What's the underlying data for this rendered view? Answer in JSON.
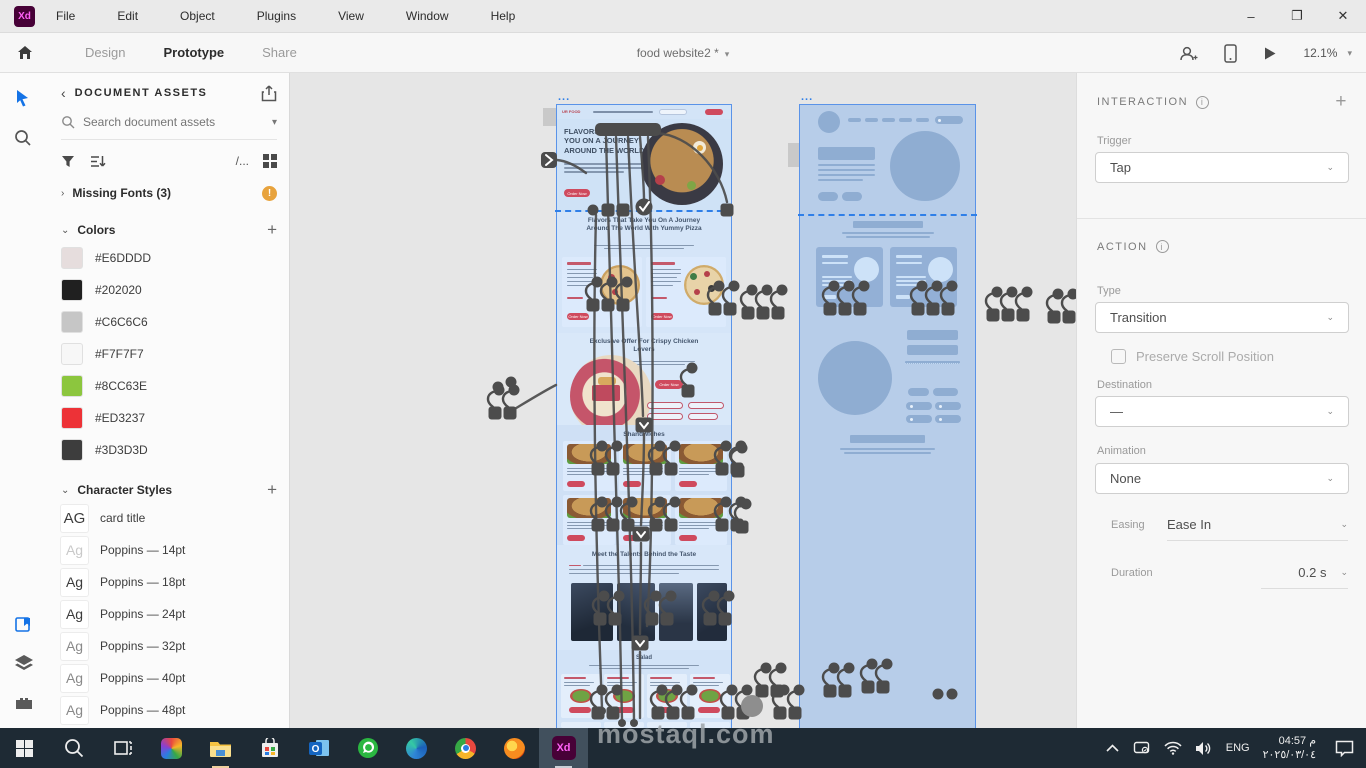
{
  "window": {
    "logo": "Xd",
    "menus": [
      "File",
      "Edit",
      "Object",
      "Plugins",
      "View",
      "Window",
      "Help"
    ],
    "controls": {
      "minimize": "–",
      "restore": "❐",
      "close": "✕"
    }
  },
  "toolbar": {
    "tabs": [
      "Design",
      "Prototype",
      "Share"
    ],
    "active_tab": "Prototype",
    "document_title": "food website2 *",
    "zoom_level": "12.1%"
  },
  "assets_panel": {
    "header": "DOCUMENT ASSETS",
    "back_chevron": "‹",
    "search_placeholder": "Search document assets",
    "list_path": "/...",
    "missing_fonts_label": "Missing Fonts (3)",
    "missing_fonts_badge": "!",
    "colors_header": "Colors",
    "colors": [
      "#E6DDDD",
      "#202020",
      "#C6C6C6",
      "#F7F7F7",
      "#8CC63E",
      "#ED3237",
      "#3D3D3D"
    ],
    "character_styles_header": "Character Styles",
    "character_styles": [
      {
        "sample": "AG",
        "label": "card title"
      },
      {
        "sample": "Ag",
        "label": "Poppins — 14pt"
      },
      {
        "sample": "Ag",
        "label": "Poppins — 18pt"
      },
      {
        "sample": "Ag",
        "label": "Poppins — 24pt"
      },
      {
        "sample": "Ag",
        "label": "Poppins — 32pt"
      },
      {
        "sample": "Ag",
        "label": "Poppins — 40pt"
      },
      {
        "sample": "Ag",
        "label": "Poppins — 48pt"
      }
    ]
  },
  "canvas": {
    "artboard_design": {
      "title_dots": "...",
      "logo": "UR FOOD",
      "hero_heading": "FLAVORS THAT TAKE YOU ON A JOURNEY AROUND THE WORLD",
      "order_now": "Order Now",
      "section_pizza_heading": "Flavors That Take You On A Journey Around The World With Yummy Pizza",
      "section_chicken_heading": "Exclusive Offer For Crispy Chicken Lovers",
      "section_sandwich_heading": "Shandwiches",
      "section_chefs_heading": "Meet the Talents Behind the Taste",
      "section_salad_heading": "Salad"
    },
    "artboard_wireframe": {
      "title_dots": "..."
    }
  },
  "inspector": {
    "interaction_header": "INTERACTION",
    "add_button": "+",
    "trigger_label": "Trigger",
    "trigger_value": "Tap",
    "action_header": "ACTION",
    "type_label": "Type",
    "type_value": "Transition",
    "preserve_scroll_label": "Preserve Scroll Position",
    "destination_label": "Destination",
    "destination_value": "—",
    "animation_label": "Animation",
    "animation_value": "None",
    "easing_label": "Easing",
    "easing_value": "Ease In",
    "duration_label": "Duration",
    "duration_value": "0.2 s"
  },
  "taskbar": {
    "language": "ENG",
    "time": "04:57 م",
    "date": "٢٠٢٥/٠٣/٠٤"
  },
  "watermark": "mostaql.com",
  "theme": {
    "accent_blue": "#2680EB",
    "warning_orange": "#E8A33D",
    "xd_plum": "#470137",
    "xd_magenta": "#FF61F6",
    "brand_red": "#ED3237",
    "brand_green": "#8CC63E",
    "taskbar_bg": "#1E2A34"
  }
}
